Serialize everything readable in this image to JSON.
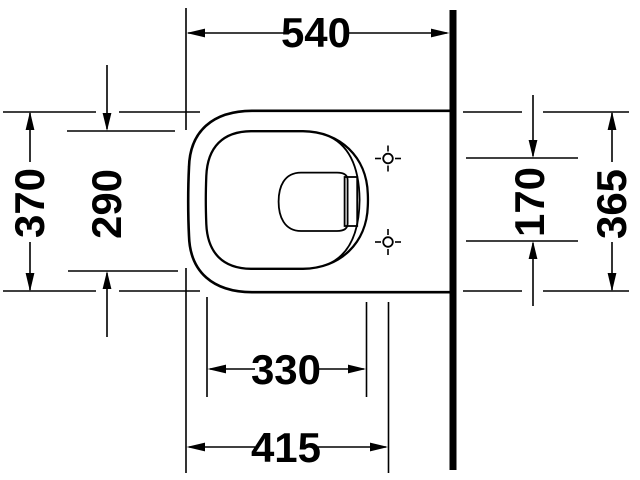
{
  "drawing": {
    "subject": "wall-hung-toilet-plan-view-technical-drawing",
    "background_color": "#ffffff",
    "line_color": "#000000",
    "dimensions": {
      "top": "540",
      "left_outer": "370",
      "left_inner": "290",
      "right_inner": "170",
      "right_outer": "365",
      "bottom_inner": "330",
      "bottom_outer": "415"
    }
  }
}
